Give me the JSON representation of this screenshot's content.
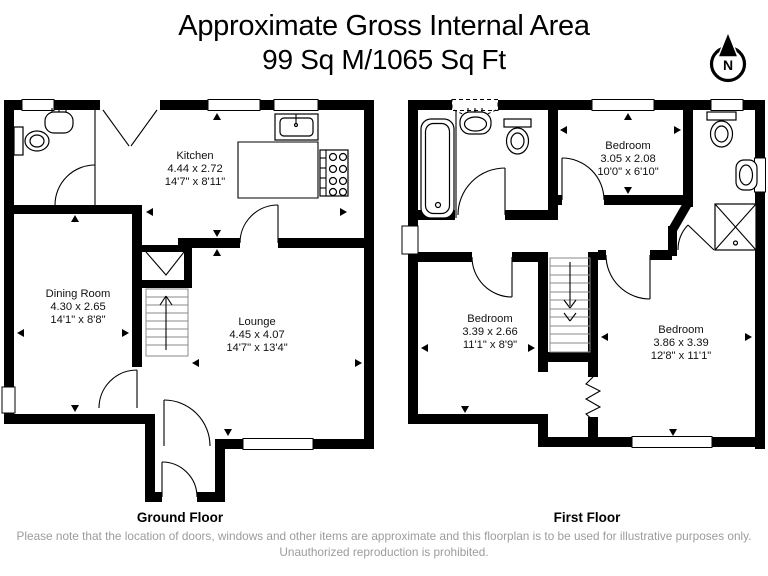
{
  "title": {
    "line1": "Approximate Gross Internal Area",
    "line2": "99 Sq M/1065 Sq Ft"
  },
  "compass": {
    "label": "N"
  },
  "ground_floor": {
    "label": "Ground Floor",
    "rooms": {
      "kitchen": {
        "name": "Kitchen",
        "metric": "4.44 x 2.72",
        "imperial": "14'7\" x 8'11\""
      },
      "dining": {
        "name": "Dining Room",
        "metric": "4.30 x 2.65",
        "imperial": "14'1\" x 8'8\""
      },
      "lounge": {
        "name": "Lounge",
        "metric": "4.45 x 4.07",
        "imperial": "14'7\" x 13'4\""
      }
    }
  },
  "first_floor": {
    "label": "First Floor",
    "rooms": {
      "bedroom1": {
        "name": "Bedroom",
        "metric": "3.05 x 2.08",
        "imperial": "10'0\" x 6'10\""
      },
      "bedroom2": {
        "name": "Bedroom",
        "metric": "3.39 x 2.66",
        "imperial": "11'1\" x 8'9\""
      },
      "bedroom3": {
        "name": "Bedroom",
        "metric": "3.86 x 3.39",
        "imperial": "12'8\" x 11'1\""
      }
    }
  },
  "disclaimer": "Please note that the location of doors, windows and other items are approximate and this floorplan is to be used for illustrative purposes only. Unauthorized reproduction is prohibited.",
  "colors": {
    "wall": "#000000",
    "text": "#000000",
    "disclaimer": "#9c9c9c",
    "background": "#ffffff"
  }
}
